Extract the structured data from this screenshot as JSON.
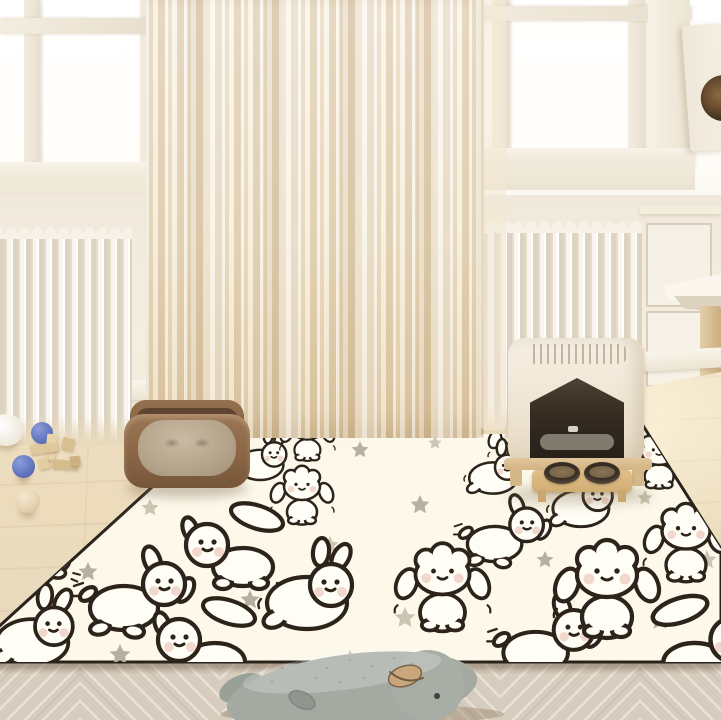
{
  "scene": {
    "objects": [
      {
        "name": "window-left"
      },
      {
        "name": "window-right"
      },
      {
        "name": "sheer-curtain"
      },
      {
        "name": "radiator-left"
      },
      {
        "name": "radiator-right"
      },
      {
        "name": "cat-tree-box"
      },
      {
        "name": "cat-tree-shelf"
      },
      {
        "name": "cat-tree-post"
      },
      {
        "name": "puppy-pattern-rug"
      },
      {
        "name": "pet-bed"
      },
      {
        "name": "litter-box"
      },
      {
        "name": "feeding-bowls-stand"
      },
      {
        "name": "blue-ball"
      },
      {
        "name": "blue-ball"
      },
      {
        "name": "wooden-blocks"
      },
      {
        "name": "cream-ball"
      },
      {
        "name": "white-bowl"
      },
      {
        "name": "plush-whale"
      },
      {
        "name": "herringbone-floor"
      }
    ]
  },
  "palette": {
    "rug_cream": "#fcf8ea",
    "outline_ink": "#2c241b",
    "blush": "#ecc8bb",
    "curtain_beige": "#ecdcc0",
    "radiator_white": "#f6f2ea",
    "wall_white": "#f3ecdf",
    "glass_white": "#ffffff",
    "floor_mid": "#ead9bb",
    "floor_front": "#d8cec0",
    "bed_brown": "#8a6646",
    "bed_cushion": "#bcab93",
    "litter_cream": "#efe8da",
    "litter_wood": "#dcc094",
    "litter_opening": "#352c22",
    "bowl_dark": "#352c23",
    "food_brown": "#7a6547",
    "ball_blue": "#6478c2",
    "block_wood": "#dfc89c",
    "cream_ball": "#e7d7b8",
    "whale_gray": "#a0a79f",
    "whale_mouth": "#c9a77b"
  },
  "rug": {
    "fill": "#fcf8ea",
    "border": "#29231c",
    "star_colors": {
      "a": "#b7b0a1",
      "b": "#ccc5b3"
    },
    "pattern": {
      "puppies": [
        {
          "x": 100,
          "y": 468,
          "v": 3,
          "s": 0.62,
          "flip": false
        },
        {
          "x": 262,
          "y": 462,
          "v": 3,
          "s": 0.58,
          "flip": true
        },
        {
          "x": 310,
          "y": 437,
          "v": 1,
          "s": 0.52,
          "flip": false
        },
        {
          "x": 305,
          "y": 497,
          "v": 1,
          "s": 0.6,
          "flip": false
        },
        {
          "x": 520,
          "y": 443,
          "v": 1,
          "s": 0.55,
          "flip": false
        },
        {
          "x": 495,
          "y": 475,
          "v": 3,
          "s": 0.6,
          "flip": true
        },
        {
          "x": 662,
          "y": 462,
          "v": 1,
          "s": 0.58,
          "flip": false
        },
        {
          "x": 40,
          "y": 545,
          "v": 4,
          "s": 0.85,
          "flip": false
        },
        {
          "x": 238,
          "y": 550,
          "v": 4,
          "s": 1.0,
          "flip": false
        },
        {
          "x": 583,
          "y": 505,
          "v": 3,
          "s": 0.7,
          "flip": true
        },
        {
          "x": 505,
          "y": 540,
          "v": 2,
          "s": 0.8,
          "flip": false
        },
        {
          "x": 690,
          "y": 545,
          "v": 1,
          "s": 0.8,
          "flip": false
        },
        {
          "x": 35,
          "y": 638,
          "v": 3,
          "s": 0.9,
          "flip": true
        },
        {
          "x": 137,
          "y": 603,
          "v": 2,
          "s": 1.0,
          "flip": false
        },
        {
          "x": 310,
          "y": 598,
          "v": 3,
          "s": 1.0,
          "flip": true
        },
        {
          "x": 210,
          "y": 645,
          "v": 4,
          "s": 1.0,
          "flip": false
        },
        {
          "x": 447,
          "y": 590,
          "v": 1,
          "s": 0.9,
          "flip": false
        },
        {
          "x": 548,
          "y": 648,
          "v": 2,
          "s": 0.95,
          "flip": false
        },
        {
          "x": 612,
          "y": 592,
          "v": 1,
          "s": 1.0,
          "flip": false
        },
        {
          "x": 700,
          "y": 645,
          "v": 4,
          "s": 1.05,
          "flip": true
        }
      ],
      "stars": [
        {
          "x": 175,
          "y": 432,
          "s": 8,
          "c": "a"
        },
        {
          "x": 360,
          "y": 450,
          "s": 9,
          "c": "a"
        },
        {
          "x": 575,
          "y": 470,
          "s": 8,
          "c": "b"
        },
        {
          "x": 435,
          "y": 443,
          "s": 7,
          "c": "b"
        },
        {
          "x": 712,
          "y": 470,
          "s": 9,
          "c": "a"
        },
        {
          "x": 150,
          "y": 508,
          "s": 9,
          "c": "b"
        },
        {
          "x": 420,
          "y": 505,
          "s": 10,
          "c": "a"
        },
        {
          "x": 645,
          "y": 498,
          "s": 8,
          "c": "b"
        },
        {
          "x": 88,
          "y": 572,
          "s": 10,
          "c": "a"
        },
        {
          "x": 330,
          "y": 545,
          "s": 9,
          "c": "b"
        },
        {
          "x": 545,
          "y": 560,
          "s": 9,
          "c": "a"
        },
        {
          "x": 707,
          "y": 560,
          "s": 10,
          "c": "b"
        },
        {
          "x": 58,
          "y": 612,
          "s": 11,
          "c": "b"
        },
        {
          "x": 250,
          "y": 600,
          "s": 10,
          "c": "a"
        },
        {
          "x": 405,
          "y": 618,
          "s": 11,
          "c": "b"
        },
        {
          "x": 660,
          "y": 620,
          "s": 11,
          "c": "a"
        },
        {
          "x": 120,
          "y": 655,
          "s": 11,
          "c": "a"
        },
        {
          "x": 350,
          "y": 660,
          "s": 10,
          "c": "b"
        },
        {
          "x": 520,
          "y": 652,
          "s": 11,
          "c": "a"
        },
        {
          "x": 695,
          "y": 690,
          "s": 10,
          "c": "b"
        }
      ]
    }
  }
}
